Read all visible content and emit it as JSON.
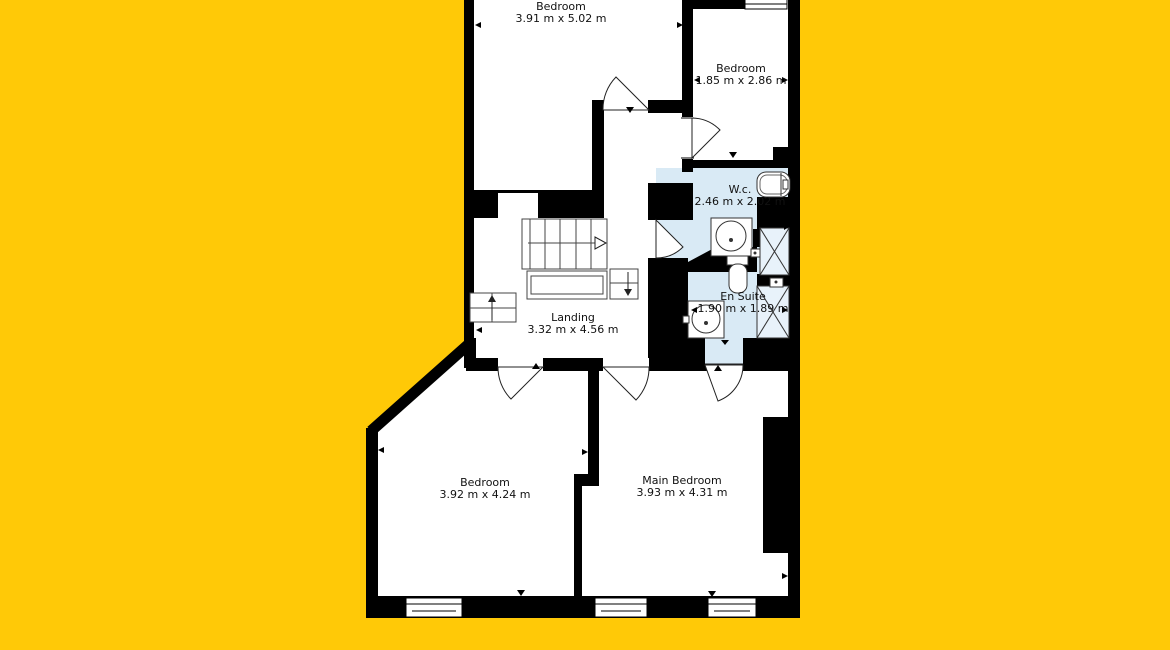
{
  "plan": {
    "type": "floor-plan",
    "colors": {
      "background": "#FFC907",
      "wall": "#000000",
      "room_floor": "#FFFFFF",
      "wet_room_floor": "#D9EAF5"
    },
    "rooms": [
      {
        "id": "bedroom-top",
        "name": "Bedroom",
        "dims": "3.91 m x 5.02 m"
      },
      {
        "id": "bedroom-small",
        "name": "Bedroom",
        "dims": "1.85 m x 2.86 m"
      },
      {
        "id": "wc",
        "name": "W.c.",
        "dims": "2.46 m x 2.02 m"
      },
      {
        "id": "en-suite",
        "name": "En Suite",
        "dims": "1.90 m x 1.89 m"
      },
      {
        "id": "landing",
        "name": "Landing",
        "dims": "3.32 m x 4.56 m"
      },
      {
        "id": "bedroom-bottom-left",
        "name": "Bedroom",
        "dims": "3.92 m x 4.24 m"
      },
      {
        "id": "main-bedroom",
        "name": "Main Bedroom",
        "dims": "3.93 m x 4.31 m"
      }
    ]
  }
}
